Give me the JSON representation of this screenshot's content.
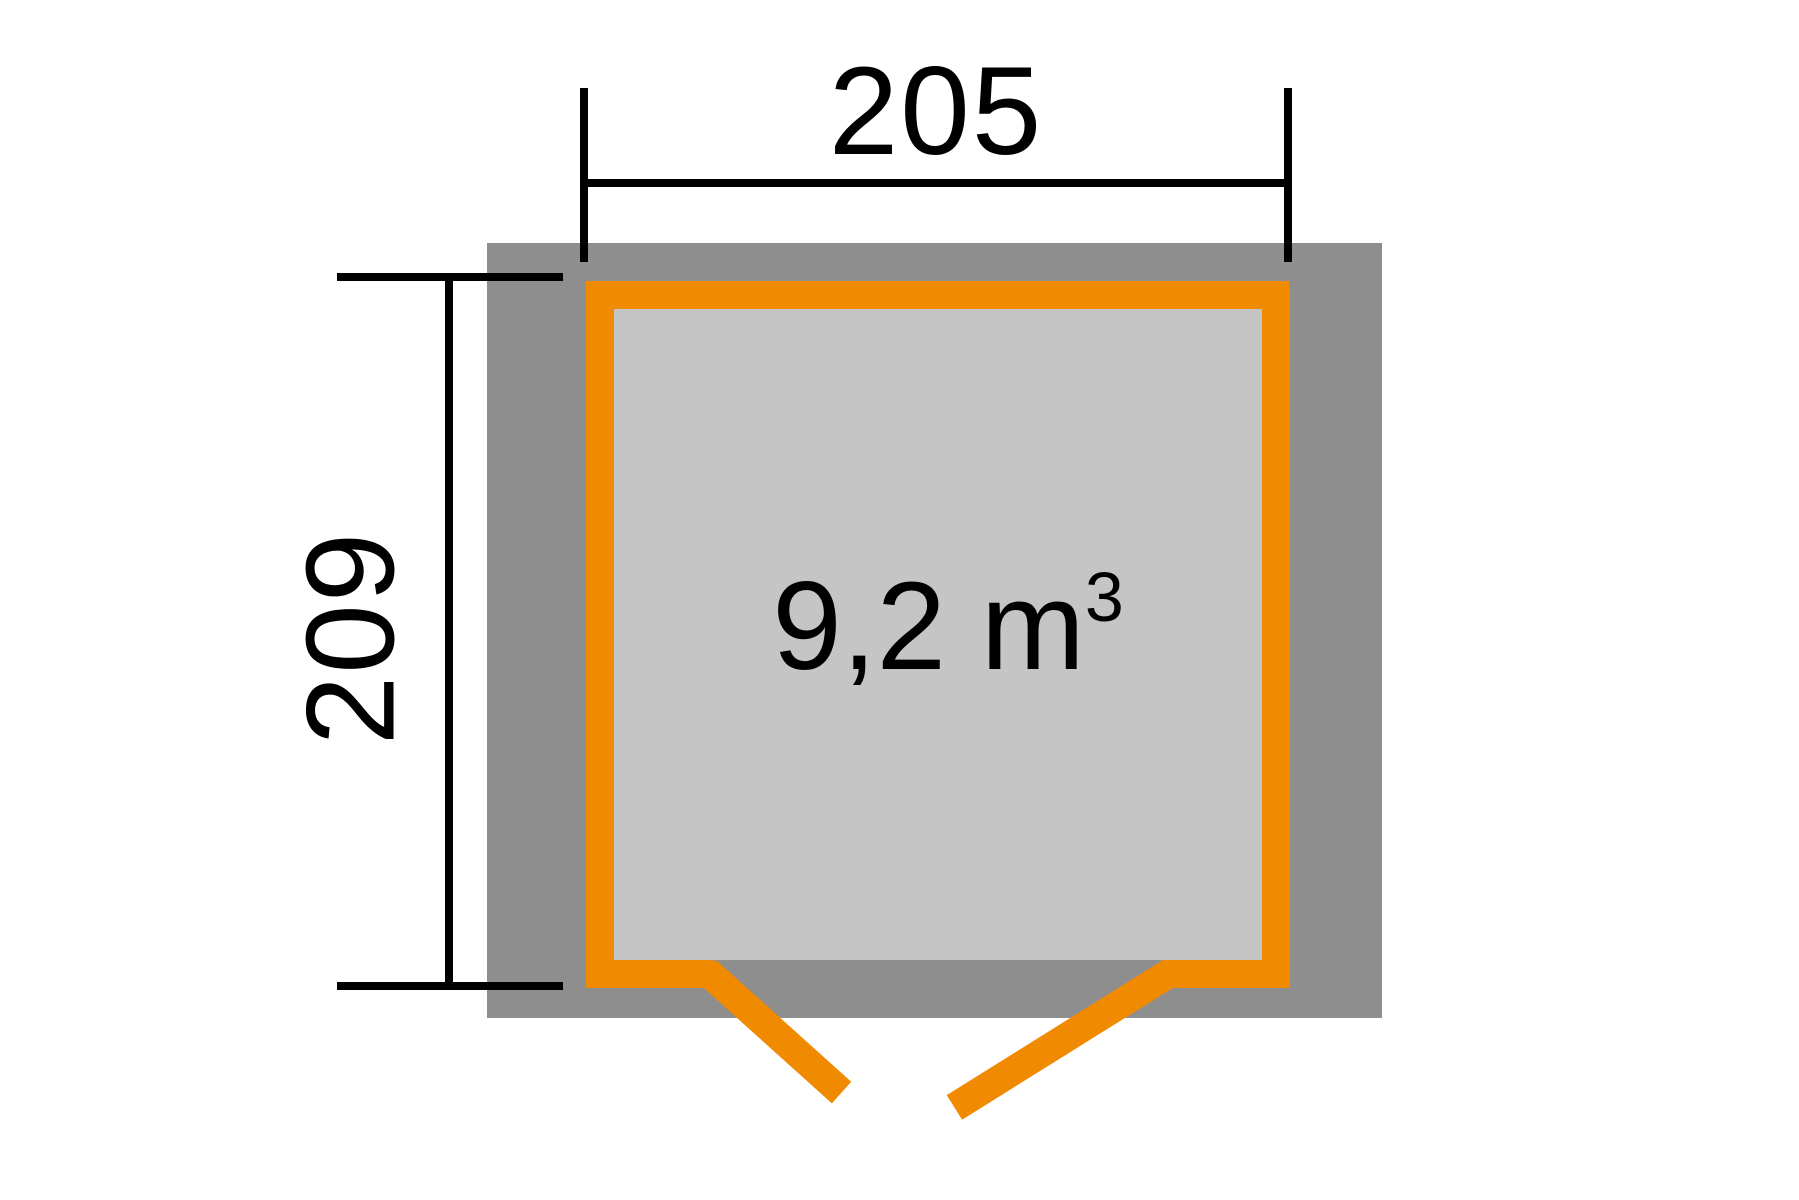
{
  "diagram": {
    "type": "shed-floor-plan",
    "volume_label": {
      "value": "9,2 m",
      "superscript": "3"
    },
    "width_dimension": {
      "label": "205"
    },
    "depth_dimension": {
      "label": "209"
    },
    "colors": {
      "wall_gray": "#8e8e8e",
      "interior_gray": "#c5c5c5",
      "frame_orange": "#f08a00",
      "line_black": "#000000",
      "bg_white": "#ffffff"
    }
  }
}
